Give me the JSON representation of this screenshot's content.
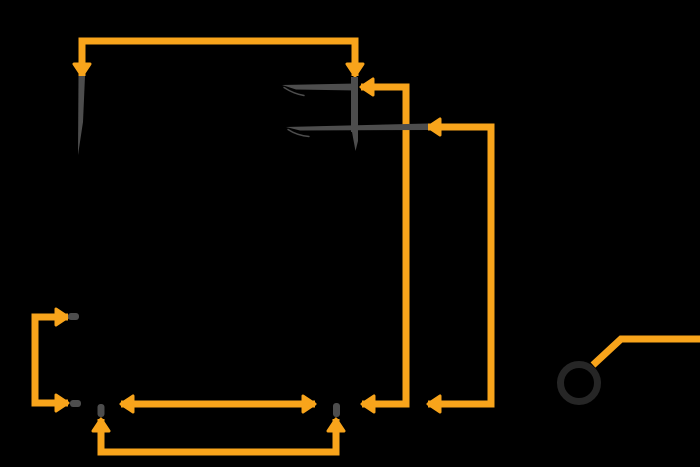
{
  "canvas": {
    "width": 700,
    "height": 467,
    "background": "#000000"
  },
  "colors": {
    "flow": "#F8A41B",
    "metal": "#4D4D4D",
    "ring": "#262626"
  },
  "style": {
    "line_width": 7,
    "head_length": 12,
    "head_width": 16
  },
  "flows": [
    {
      "name": "top-span-arrow",
      "points": [
        [
          82,
          76
        ],
        [
          82,
          41
        ],
        [
          355,
          41
        ],
        [
          355,
          76
        ]
      ],
      "head_start": true,
      "head_end": true
    },
    {
      "name": "inner-return-arrow",
      "points": [
        [
          361,
          87
        ],
        [
          406,
          87
        ],
        [
          406,
          404
        ],
        [
          362,
          404
        ]
      ],
      "head_start": true,
      "head_end": true
    },
    {
      "name": "outer-return-arrow",
      "points": [
        [
          428,
          127
        ],
        [
          491,
          127
        ],
        [
          491,
          404
        ],
        [
          428,
          404
        ]
      ],
      "head_start": true,
      "head_end": true
    },
    {
      "name": "left-bracket-arrow",
      "points": [
        [
          68,
          317
        ],
        [
          35,
          317
        ],
        [
          35,
          403
        ],
        [
          68,
          403
        ]
      ],
      "head_start": true,
      "head_end": true
    },
    {
      "name": "horizontal-span-arrow",
      "points": [
        [
          121,
          404
        ],
        [
          315,
          404
        ]
      ],
      "head_start": true,
      "head_end": true
    },
    {
      "name": "bottom-link-arrow",
      "points": [
        [
          101,
          419
        ],
        [
          101,
          452
        ],
        [
          336,
          452
        ],
        [
          336,
          419
        ]
      ],
      "head_start": true,
      "head_end": true
    },
    {
      "name": "lever-wire",
      "points": [
        [
          593,
          365
        ],
        [
          621,
          339
        ],
        [
          700,
          339
        ]
      ],
      "head_start": false,
      "head_end": false
    }
  ],
  "parts": [
    {
      "name": "pointer-needle",
      "type": "polygon",
      "points": [
        [
          78.5,
          76
        ],
        [
          85,
          76
        ],
        [
          83,
          122
        ],
        [
          78,
          155
        ]
      ]
    },
    {
      "name": "fork-stem",
      "type": "line",
      "x1": 354.5,
      "y1": 77,
      "x2": 354.5,
      "y2": 132,
      "width": 7
    },
    {
      "name": "fork-upper-finger",
      "type": "polygon",
      "points": [
        [
          282,
          85
        ],
        [
          356,
          83.5
        ],
        [
          356,
          90.5
        ],
        [
          296,
          89.5
        ]
      ]
    },
    {
      "name": "fork-upper-finger-flick",
      "type": "curve",
      "d": "M 284,87.5 Q 294,94 304,95.5",
      "width": 1.4
    },
    {
      "name": "fork-lower-finger",
      "type": "polygon",
      "points": [
        [
          286,
          127
        ],
        [
          428,
          123.5
        ],
        [
          428,
          130
        ],
        [
          300,
          130.5
        ]
      ]
    },
    {
      "name": "fork-lower-finger-flick",
      "type": "curve",
      "d": "M 288,129.5 Q 297,135.5 309,136.5",
      "width": 1.4
    },
    {
      "name": "fork-tail",
      "type": "polygon",
      "points": [
        [
          352,
          132
        ],
        [
          358,
          132
        ],
        [
          358,
          141
        ],
        [
          355.5,
          151
        ]
      ]
    },
    {
      "name": "contact-pin-upper-left",
      "type": "pin",
      "x": 68,
      "y": 313,
      "w": 11,
      "h": 7,
      "rx": 3
    },
    {
      "name": "contact-pin-lower-left",
      "type": "pin",
      "x": 70,
      "y": 400,
      "w": 11,
      "h": 7,
      "rx": 3
    },
    {
      "name": "contact-pin-bottom-left",
      "type": "pin",
      "x": 97.5,
      "y": 404,
      "w": 7,
      "h": 13,
      "rx": 3
    },
    {
      "name": "contact-pin-bottom-right",
      "type": "pin",
      "x": 333,
      "y": 403,
      "w": 7,
      "h": 14,
      "rx": 3
    },
    {
      "name": "pivot-ring",
      "type": "ring",
      "cx": 579,
      "cy": 383,
      "r": 18.5,
      "width": 7
    }
  ]
}
